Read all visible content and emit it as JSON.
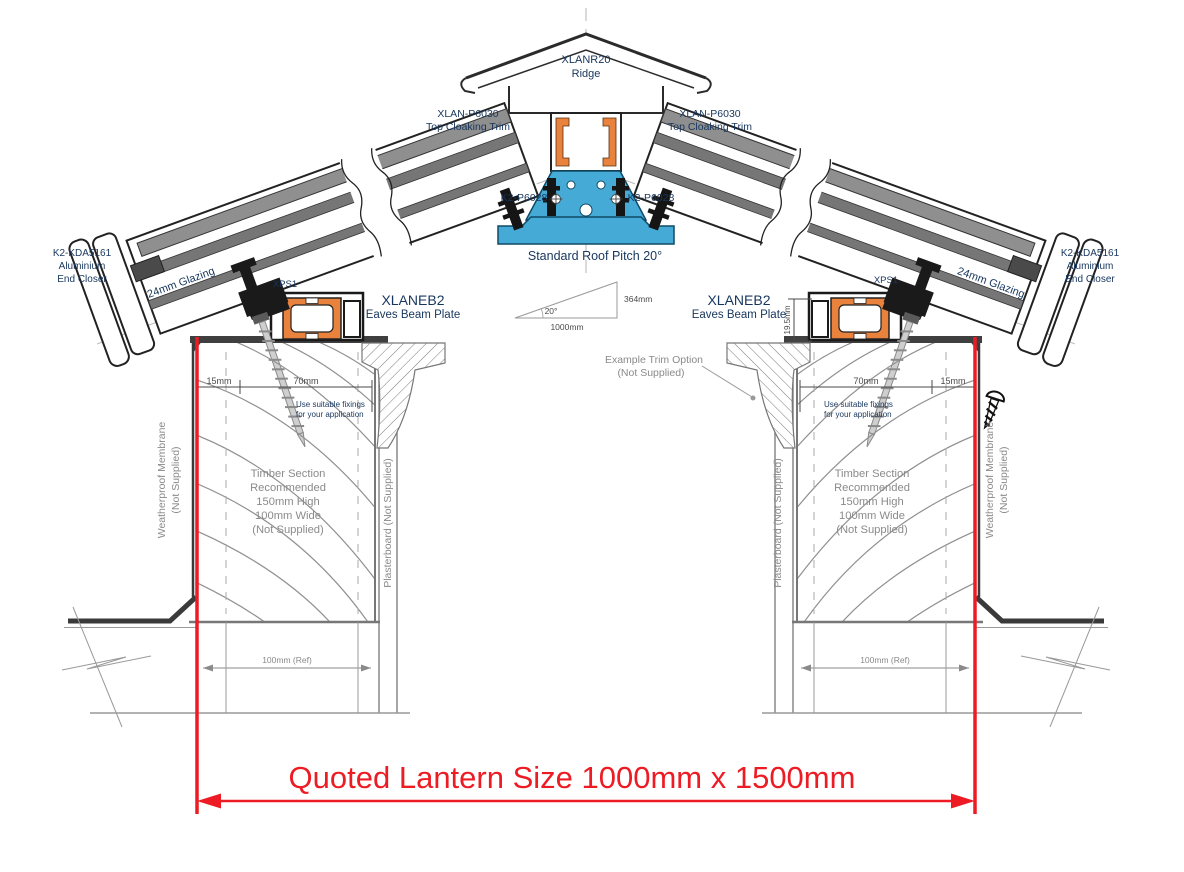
{
  "title": "Roof lantern cross-section installation drawing",
  "colors": {
    "label_navy": "#17365D",
    "annotation_gray": "#8a8a8a",
    "dimension_gray": "#4a4a4a",
    "red": "#ED1C24",
    "thermal_break_orange": "#E8823C",
    "ridge_profile_blue": "#45ABD6",
    "outline_black": "#1a1a1a"
  },
  "ridge": {
    "code": "XLANR20",
    "name": "Ridge"
  },
  "top_cloaking_trim": {
    "code": "XLAN-P6030",
    "name": "Top Cloaking Trim"
  },
  "ridge_bracket": {
    "code": "K2-P6028"
  },
  "end_closer": {
    "code": "K2-KDA5161",
    "line1": "Aluminium",
    "line2": "End Closer"
  },
  "glazing": {
    "label": "24mm Glazing"
  },
  "clamp": {
    "code": "XPS1"
  },
  "eaves_beam": {
    "code": "XLANEB2",
    "name": "Eaves Beam Plate"
  },
  "pitch": {
    "title": "Standard Roof Pitch 20°",
    "angle": "20°",
    "base": "1000mm",
    "rise": "364mm"
  },
  "dimensions": {
    "edge": "15mm",
    "fixing_zone": "70mm",
    "beam_height": "19.5mm",
    "ref_width": "100mm (Ref)"
  },
  "notes": {
    "fixings_line1": "Use suitable fixings",
    "fixings_line2": "for your application",
    "timber_line1": "Timber Section",
    "timber_line2": "Recommended",
    "timber_line3": "150mm High",
    "timber_line4": "100mm Wide",
    "timber_line5": "(Not Supplied)",
    "membrane_line1": "Weatherproof Membrane",
    "membrane_line2": "(Not Supplied)",
    "plasterboard": "Plasterboard (Not Supplied)",
    "trim_line1": "Example  Trim Option",
    "trim_line2": "(Not Supplied)"
  },
  "quoted_size": {
    "label": "Quoted Lantern Size 1000mm x 1500mm"
  }
}
